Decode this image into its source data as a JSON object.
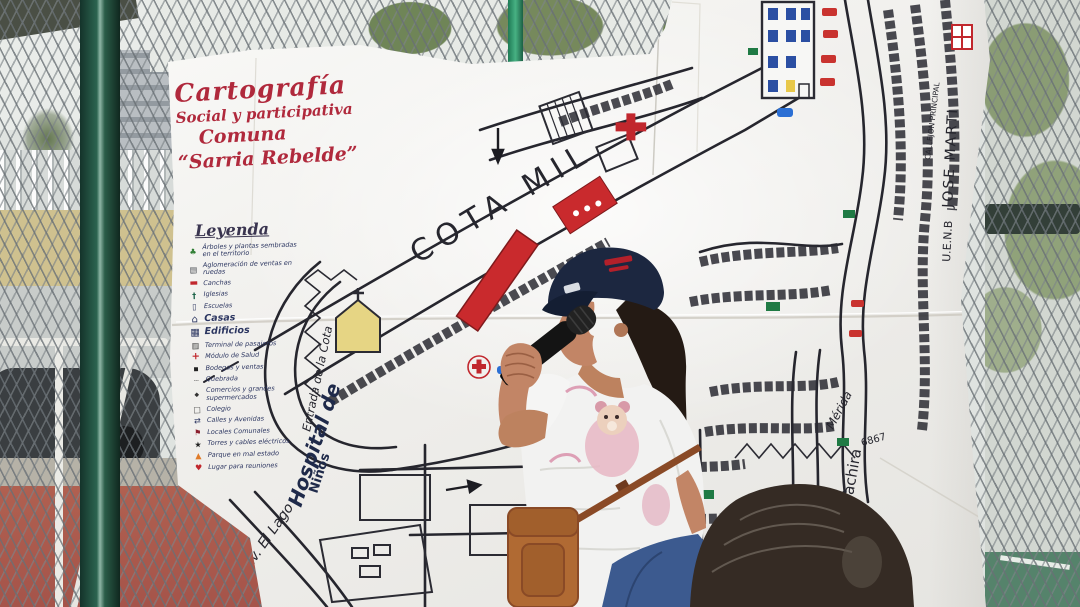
{
  "poster": {
    "title": {
      "line1": "Cartografía",
      "line2": "Social y participativa",
      "line3": "Comuna",
      "line4": "“Sarria Rebelde”"
    },
    "legend": {
      "title": "Leyenda",
      "items": [
        {
          "icon": "plant-icon",
          "glyph": "♣",
          "label": "Árboles y plantas sembradas en el territorio"
        },
        {
          "icon": "street-vendors-icon",
          "glyph": "▤",
          "label": "Aglomeración de ventas en ruedas"
        },
        {
          "icon": "sports-court-icon",
          "glyph": "▬",
          "label": "Canchas"
        },
        {
          "icon": "church-icon",
          "glyph": "†",
          "label": "Iglesias"
        },
        {
          "icon": "school-icon",
          "glyph": "▯",
          "label": "Escuelas"
        },
        {
          "icon": "houses-icon",
          "glyph": "⌂",
          "label": "Casas"
        },
        {
          "icon": "buildings-icon",
          "glyph": "▦",
          "label": "Edificios"
        },
        {
          "icon": "terminal-icon",
          "glyph": "▥",
          "label": "Terminal de pasajeros"
        },
        {
          "icon": "health-cross-icon",
          "glyph": "+",
          "label": "Módulo de Salud"
        },
        {
          "icon": "shops-icon",
          "glyph": "▪",
          "label": "Bodegas y ventas"
        },
        {
          "icon": "creek-dashes-icon",
          "glyph": "┄",
          "label": "Quebrada"
        },
        {
          "icon": "supermarket-icon",
          "glyph": "◆",
          "label": "Comercios y grandes supermercados"
        },
        {
          "icon": "square-icon",
          "glyph": "□",
          "label": "Colegio"
        },
        {
          "icon": "arrows-icon",
          "glyph": "⇄",
          "label": "Calles y Avenidas"
        },
        {
          "icon": "flag-icon",
          "glyph": "⚑",
          "label": "Locales Comunales"
        },
        {
          "icon": "star-icon",
          "glyph": "★",
          "label": "Torres y cables eléctricos"
        },
        {
          "icon": "triangle-icon",
          "glyph": "▲",
          "label": "Parque en mal estado"
        },
        {
          "icon": "heart-icon",
          "glyph": "♥",
          "label": "Lugar para reuniones"
        }
      ]
    },
    "map_labels": {
      "cota_mil": "COTA MIL",
      "entrada": "Entrada de la Cota",
      "hospital_1": "Hospital de",
      "hospital_2": "Niños",
      "av_el_lago": "Av. El Lago",
      "calle": "Calle",
      "tachira": "Tachira",
      "merida": "Mérida",
      "numero": "6867",
      "jose_marti": "JOSE MARTI",
      "uenb": "U.E.N.B",
      "callejon_principal": "CALLEJON PRINCIPAL"
    }
  },
  "colors": {
    "paper": "#f4f3ef",
    "map_ink": "#26262e",
    "title_red": "#b0293c",
    "legend_navy": "#2b3560",
    "court_red": "#c92a2d",
    "church_yellow": "#e6d584",
    "window_blue": "#2b4fa3",
    "map_green": "#1f7a44",
    "fence_pole_green": "#2c6450",
    "cap_navy": "#1c2740",
    "bag_brown": "#b06a33",
    "jeans_blue": "#3c5a8f",
    "floor_red": "#a5544a"
  }
}
